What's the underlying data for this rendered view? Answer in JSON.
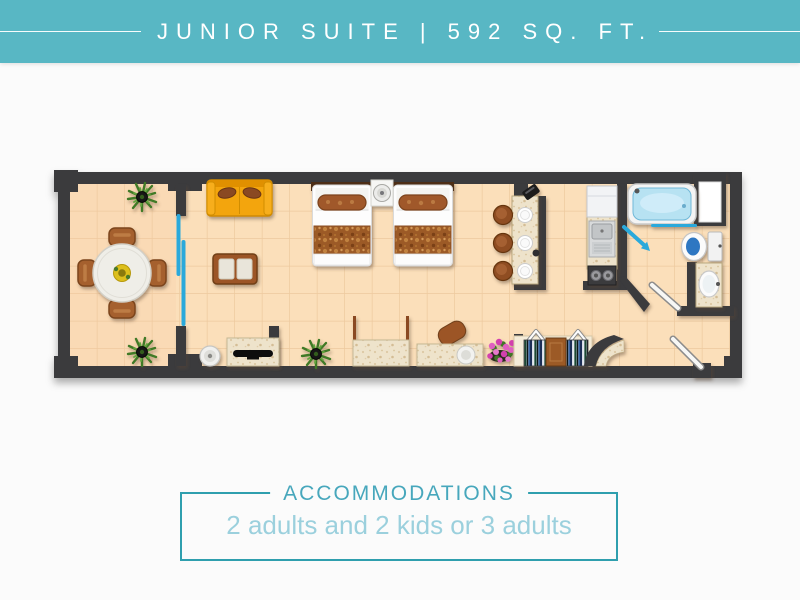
{
  "header": {
    "title": "JUNIOR SUITE | 592 SQ. FT."
  },
  "accommodations": {
    "title": "ACCOMMODATIONS",
    "capacity": "2 adults and 2 kids or 3 adults"
  },
  "floor_plan": {
    "label": "Junior Suite floor plan",
    "rooms": [
      {
        "name": "balcony",
        "furniture": [
          "round-dining-table",
          "dining-chair",
          "dining-chair",
          "dining-chair",
          "dining-chair",
          "potted-plant",
          "potted-plant",
          "sliding-glass-door"
        ]
      },
      {
        "name": "living-room",
        "furniture": [
          "sofa",
          "coffee-table",
          "tv-console",
          "tv",
          "stool",
          "potted-plant"
        ]
      },
      {
        "name": "bedroom",
        "furniture": [
          "double-bed",
          "double-bed",
          "nightstand",
          "lamp",
          "dresser",
          "desk",
          "desk-chair",
          "flower-pot"
        ]
      },
      {
        "name": "bar",
        "furniture": [
          "bar-counter",
          "bar-stool",
          "bar-stool",
          "bar-stool",
          "place-setting",
          "place-setting",
          "place-setting",
          "telephone"
        ]
      },
      {
        "name": "kitchenette",
        "furniture": [
          "fridge",
          "sink",
          "stove"
        ]
      },
      {
        "name": "bathroom",
        "furniture": [
          "bathtub",
          "shower-screen",
          "toilet",
          "vanity-sink",
          "window",
          "door"
        ]
      },
      {
        "name": "entry",
        "furniture": [
          "entry-door",
          "closet",
          "clothes-rail",
          "clothes-rail",
          "safe",
          "hanger-hooks",
          "arch"
        ]
      }
    ]
  },
  "colors": {
    "header_bg": "#58b7c4",
    "header_text": "#ffffff",
    "page_bg": "#fbfbfb",
    "box_border": "#2f9fae",
    "accommodations_title": "#47a7bc",
    "capacity_text": "#9bd0dd",
    "wall": "#3a3a3e",
    "floor_tile": "#fbdfba",
    "tile_grout": "#ecc79c",
    "marble": "#eee3cb",
    "sofa_orange": "#f3a50f",
    "wood_brown": "#9c5426",
    "bed_runner": "#9c5a28",
    "plant_green": "#417a28",
    "water_blue": "#b7e2f2",
    "accent_cyan": "#2aa9db",
    "flower_pink": "#e060c0",
    "toilet_water": "#2f77c2"
  }
}
